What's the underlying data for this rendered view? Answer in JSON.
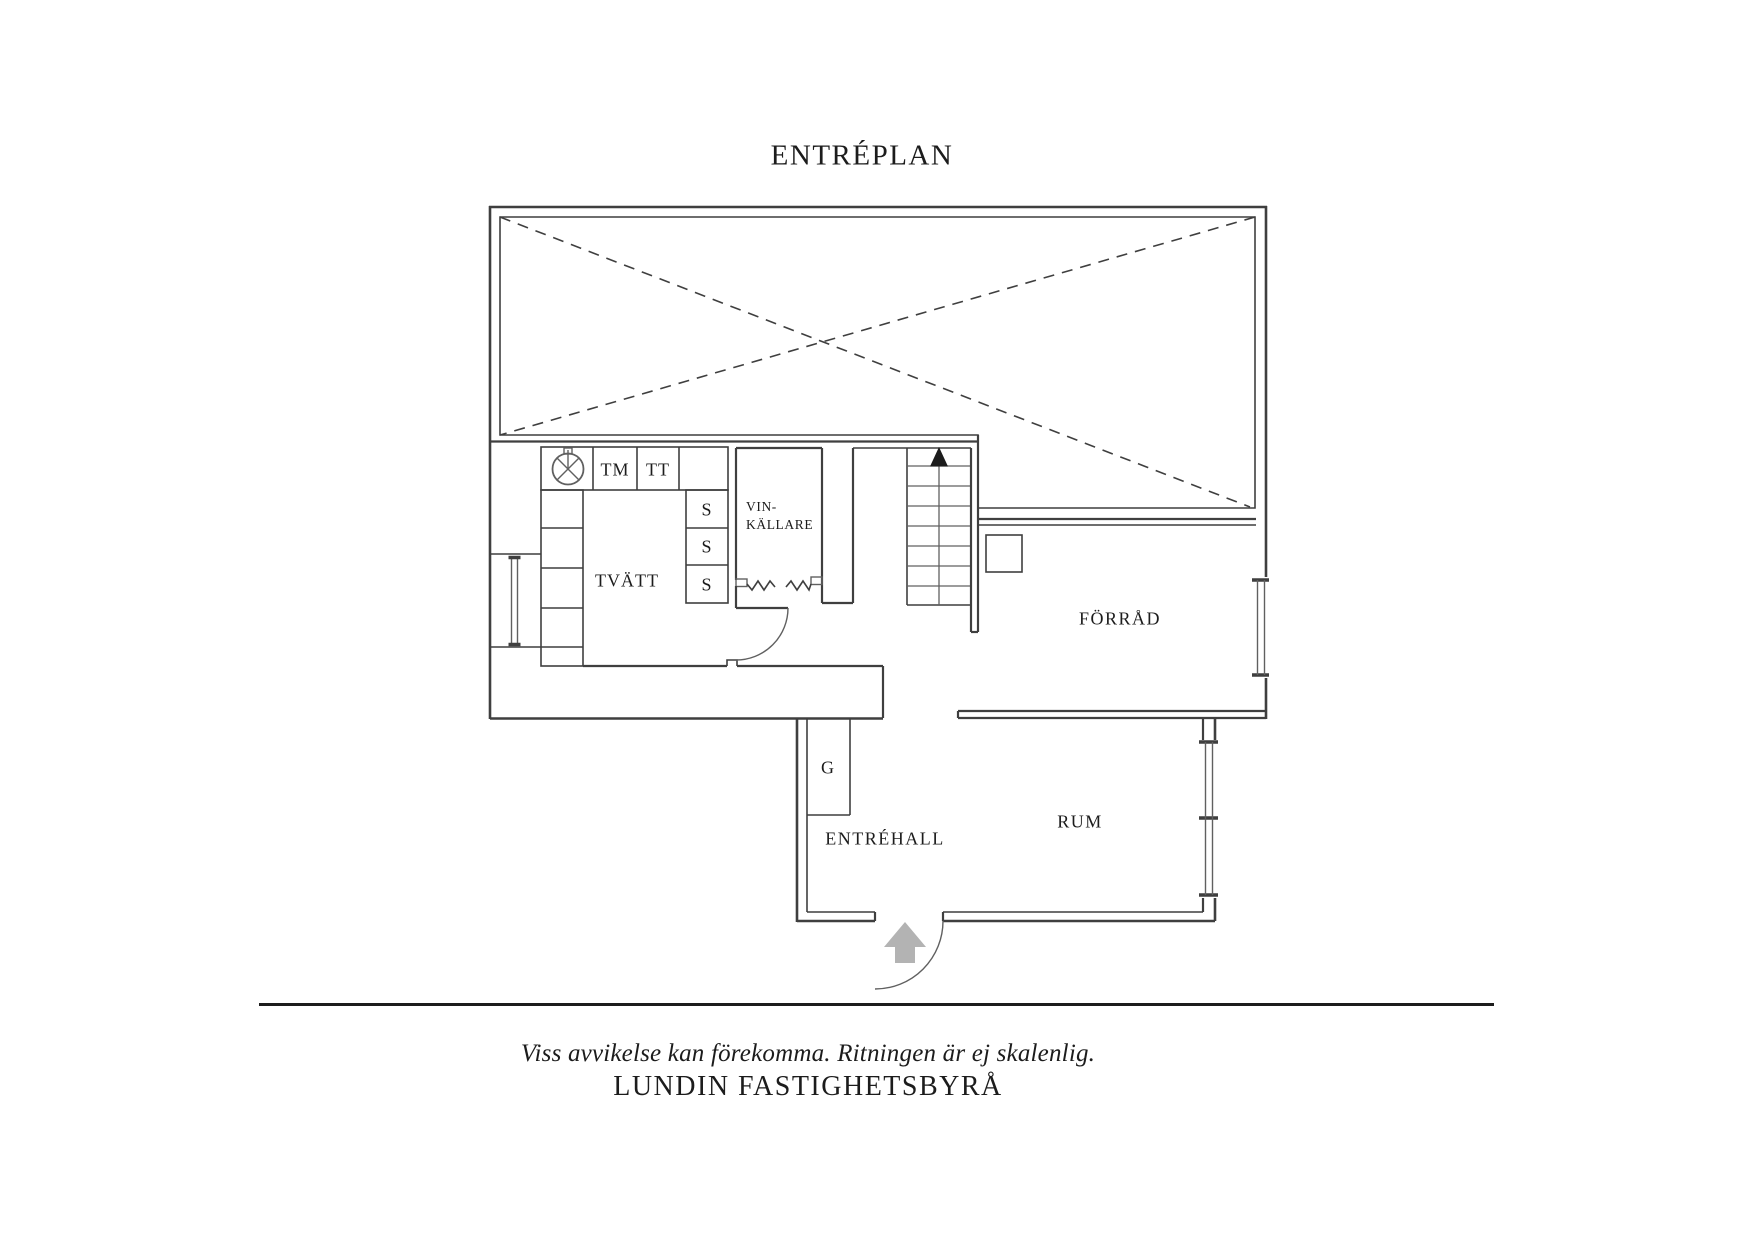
{
  "title": "ENTRÉPLAN",
  "rooms": {
    "tvatt": "TVÄTT",
    "vinkallare_line1": "VIN-",
    "vinkallare_line2": "KÄLLARE",
    "forrad": "FÖRRÅD",
    "entrehall": "ENTRÉHALL",
    "rum": "RUM"
  },
  "fixtures": {
    "tm": "TM",
    "tt": "TT",
    "s": "S",
    "g": "G"
  },
  "footer": {
    "disclaimer": "Viss avvikelse kan förekomma. Ritningen är ej skalenlig.",
    "brand": "LUNDIN FASTIGHETSBYRÅ"
  },
  "colors": {
    "wall": "#3f3f3f",
    "thin": "#606060",
    "text": "#1c1c1c",
    "arrow": "#b3b3b3",
    "bg": "#ffffff"
  }
}
